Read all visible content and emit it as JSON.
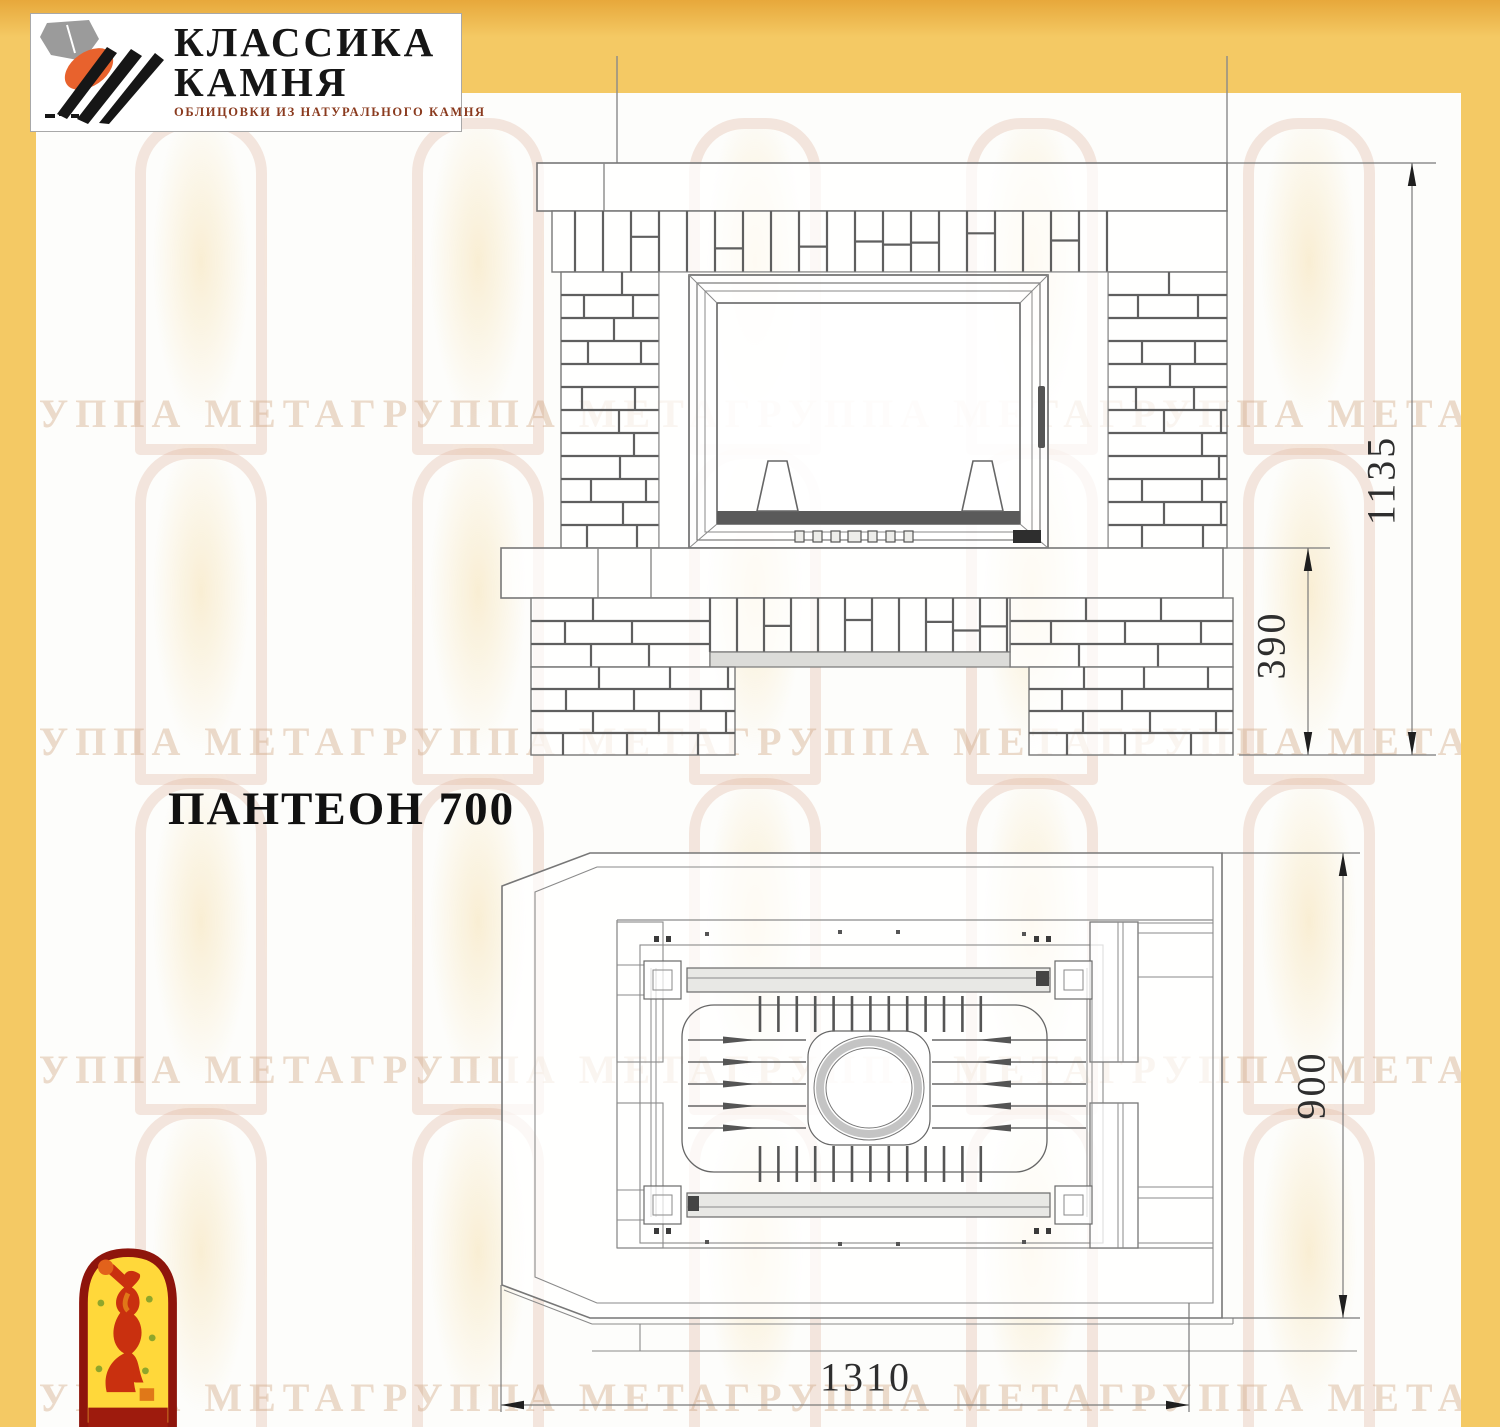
{
  "logo": {
    "title_line1": "КЛАССИКА",
    "title_line2": "КАМНЯ",
    "subtitle": "ОБЛИЦОВКИ ИЗ НАТУРАЛЬНОГО КАМНЯ"
  },
  "drawing": {
    "title": "ПАНТЕОН 700",
    "dimensions": {
      "height_total": "1135",
      "height_plinth": "390",
      "depth": "900",
      "width": "1310"
    }
  },
  "watermark": {
    "text_row": "ГРУППА МЕТАГРУППА МЕТАГРУППА МЕТАГРУППА МЕТА",
    "rows": 4
  },
  "colors": {
    "border_yellow": "#F4C964",
    "logo_orange": "#E8622D",
    "logo_subtitle_red": "#8A3A1E",
    "emblem_border_red": "#8E150C",
    "emblem_yellow": "#FFD83A",
    "emblem_figure_red": "#C9300F",
    "drawing_line_gray": "#777777",
    "dim_text_gray": "#2E2E2E"
  }
}
